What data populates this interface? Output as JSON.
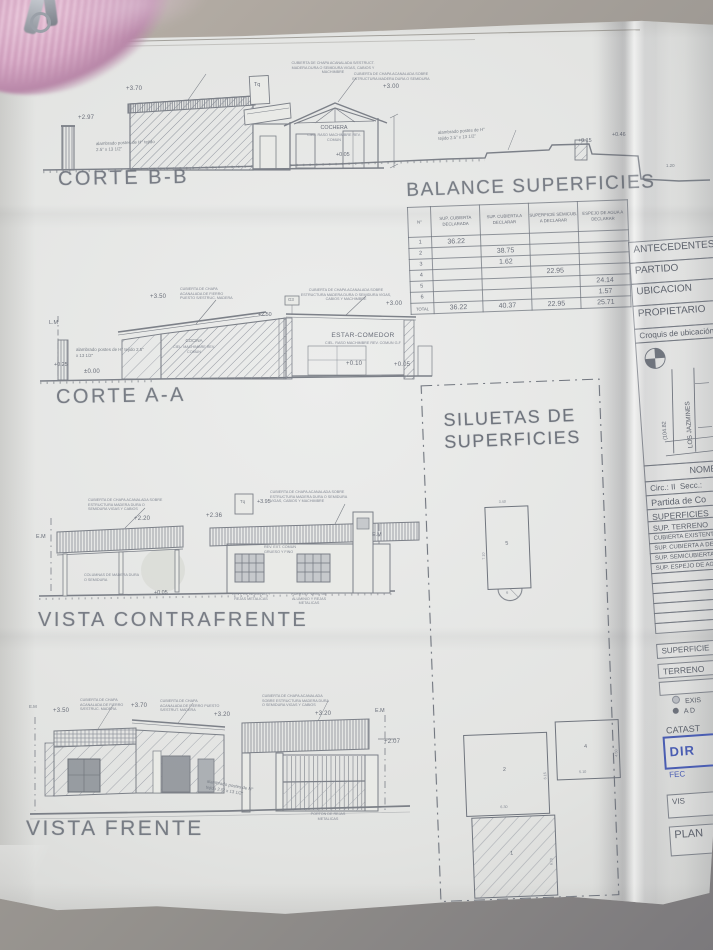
{
  "photo": {
    "accent_blue": "#4a5db2",
    "paper": "#e2e3e1",
    "background": "#a29a92",
    "line_color": "#70757e",
    "yarn_pink": "#d4a3c0"
  },
  "corte_bb": {
    "title": "CORTE B-B",
    "lvl_top": "+3.70",
    "lvl_left": "+2.97",
    "fence_note": "alambrado postes de H° tejido 2.5\" x 13 1/2\"",
    "roof_note_1": "CUBIERTA DE CHAPA ACANALADA S/ESTRUCT. MADERA DURA O SEMIDURA VIGAS, CABIOS Y MACHIMBRE",
    "roof_note_2": "CUBIERTA DE CHAPA ACANALADA SOBRE ESTRUCTURA MADERA DURA O SEMIDURA",
    "tank": "Tq",
    "lvl_house": "+3.00",
    "room": "COCHERA",
    "room_sub": "CIEL. RASO MACHIMBRE REV. COMUN",
    "lvl_floor": "+0.05",
    "fence_note_2": "alambrado postes de H° tejido 2.5\" x 13 1/2\"",
    "lvl_t1": "+0.15",
    "lvl_t2": "+0.46",
    "dim_t": "1.20"
  },
  "balance": {
    "title": "BALANCE SUPERFICIES",
    "headers": [
      "N°",
      "SUP. CUBIERTA DECLARADA",
      "SUP. CUBIERTA A DECLARAR",
      "SUPERFICIE SEMICUB. A DECLARAR",
      "ESPEJO DE AGUA A DECLARAR"
    ],
    "rows": [
      [
        "1",
        "36.22",
        "",
        "",
        ""
      ],
      [
        "2",
        "",
        "38.75",
        "",
        ""
      ],
      [
        "3",
        "",
        "1.62",
        "",
        ""
      ],
      [
        "4",
        "",
        "",
        "22.95",
        ""
      ],
      [
        "5",
        "",
        "",
        "",
        "24.14"
      ],
      [
        "6",
        "",
        "",
        "",
        "1.57"
      ],
      [
        "TOTAL",
        "36.22",
        "40.37",
        "22.95",
        "25.71"
      ]
    ]
  },
  "corte_aa": {
    "title": "CORTE A-A",
    "lm": "L.M",
    "fence_note": "alambrado postes de H° tejido 2.5\" x 13 1/2\"",
    "lvl_025": "+0.25",
    "lvl_0": "±0.00",
    "lvl_350": "+3.50",
    "roof_note_1": "CUBIERTA DE CHAPA ACANALADA DE FIERRO PUESTO S/ESTRUC. MADERA",
    "roof_note_2": "CUBIERTA DE CHAPA ACANALADA SOBRE ESTRUCTURA MADERA DURA O SEMIDURA VIGAS, CABIOS Y MACHIMBRE",
    "marker": "G3",
    "lvl_250": "+2.50",
    "lvl_300": "+3.00",
    "room_left": "COCINA",
    "room_left_sub": "CIEL. MACHIMBRE REV. COMUN",
    "room": "ESTAR-COMEDOR",
    "room_sub": "CIEL. RASO MACHIMBRE REV. COMUN G-F",
    "lvl_010": "+0.10",
    "lvl_005": "+0.05"
  },
  "siluetas": {
    "title_1": "SILUETAS DE",
    "title_2": "SUPERFICIES",
    "s5": "5",
    "s5_w": "3.40",
    "s5_h": "7.10",
    "s6": "6",
    "s2": "2",
    "s2_w": "6.30",
    "s2_h": "6.15",
    "s4": "4",
    "s4_w": "5.10",
    "s4_h": "4.50",
    "s1": "1",
    "s1_h": "6.70"
  },
  "contrafrente": {
    "title": "VISTA CONTRAFRENTE",
    "em_left": "E.M",
    "em_right": "E.M",
    "roof_note_1": "CUBIERTA DE CHAPA ACANALADA SOBRE ESTRUCTURA MADERA DURA O SEMIDURA VIGAS Y CABIOS",
    "lvl_220": "+2.20",
    "lvl_236": "+2.36",
    "tank": "Tq",
    "lvl_tank": "+3.95",
    "roof_note_2": "CUBIERTA DE CHAPA ACANALADA SOBRE ESTRUCTURA MADERA DURA O SEMIDURA VIGAS, CABIOS Y MACHIMBRE",
    "col_note": "COLUMNAS DE MADERA DURA O SEMIDURA",
    "lvl_005": "+0.05",
    "rev_note": "REV. EXT. COMUN GRUESO Y FINO",
    "win_note_1": "VENT. DE ALUMINIO Y REJAS METALICAS",
    "win_note_2": "PUERTA Y VENT. DE ALUMINIO Y REJAS METALICAS"
  },
  "frente": {
    "title": "VISTA FRENTE",
    "em_left": "E.M",
    "em_right": "E.M",
    "lvl_350": "+3.50",
    "lvl_370": "+3.70",
    "lvl_320a": "+3.20",
    "lvl_320b": "+3.20",
    "lvl_207": "+2.07",
    "roof_note_1": "CUBIERTA DE CHAPA ACANALADA DE FIERRO S/ESTRUC. MADERA",
    "roof_note_2": "CUBIERTA DE CHAPA ACANALADA DE FIERRO PUESTO S/ESTRUT. MADERA",
    "roof_note_3": "CUBIERTA DE CHAPA ACANALADA SOBRE ESTRUCTURA MADERA DURA O SEMIDURA VIGAS Y CABIOS",
    "fence_note": "alambrado postes de H° tejido 2.5\" x 13 1/2\"",
    "gate_note": "PORTON DE REJAS METALICAS"
  },
  "panel": {
    "antecedentes": "ANTECEDENTES",
    "partido": "PARTIDO",
    "ubicacion": "UBICACION",
    "propietario": "PROPIETARIO",
    "croquis": "Croquis de ubicación",
    "dim": "(104.82",
    "street": "LOS JAZMINES",
    "nomenclatura": "NOMENCLA",
    "circ": "Circ.:  II",
    "secc": "Secc.:",
    "partida": "Partida de Co",
    "superficies": "SUPERFICIES",
    "sup_terreno": "SUP. TERRENO",
    "cubierta_existente": "CUBIERTA EXISTENTE",
    "sup_cubierta": "SUP. CUBIERTA A DE",
    "sup_semicubierta": "SUP. SEMICUBIERTA",
    "sup_espejo": "SUP. ESPEJO DE AG",
    "superficie": "SUPERFICIE",
    "terreno": "TERRENO",
    "referencias": "REF",
    "ref_existente": "EXIS",
    "ref_declarar": "A D",
    "catastro": "CATAST",
    "stamp": "DIR",
    "fecha": "FEC",
    "visado": "VIS",
    "plano": "PLAN"
  }
}
